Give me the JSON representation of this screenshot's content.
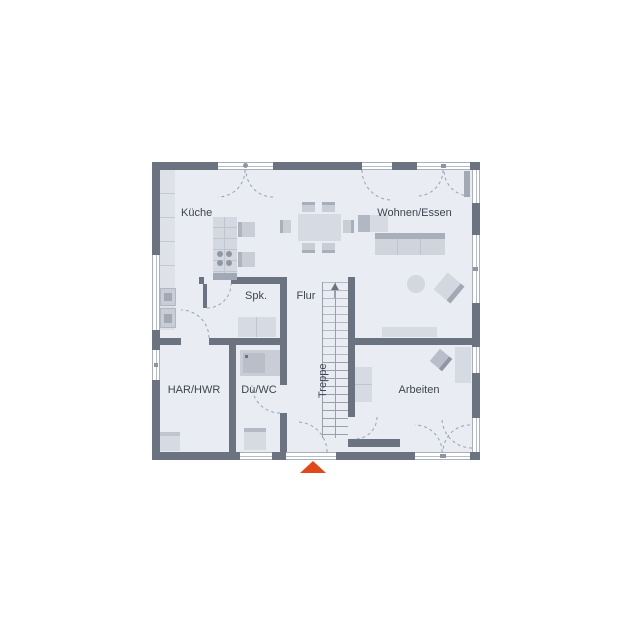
{
  "plan": {
    "rooms": [
      {
        "id": "kueche",
        "label": "Küche"
      },
      {
        "id": "wohnen-essen",
        "label": "Wohnen/Essen"
      },
      {
        "id": "spk",
        "label": "Spk."
      },
      {
        "id": "flur",
        "label": "Flur"
      },
      {
        "id": "treppe",
        "label": "Treppe"
      },
      {
        "id": "har-hwr",
        "label": "HAR/HWR"
      },
      {
        "id": "du-wc",
        "label": "Du/WC"
      },
      {
        "id": "arbeiten",
        "label": "Arbeiten"
      }
    ],
    "colors": {
      "wall": "#6b7380",
      "room_fill": "#e9ecf3",
      "furniture_light": "#d6dae2",
      "furniture_mid": "#c9cdd6",
      "furniture_dark": "#a2a9b4",
      "entrance_marker": "#e0491c"
    },
    "entrance_marker": "entrance-triangle"
  }
}
